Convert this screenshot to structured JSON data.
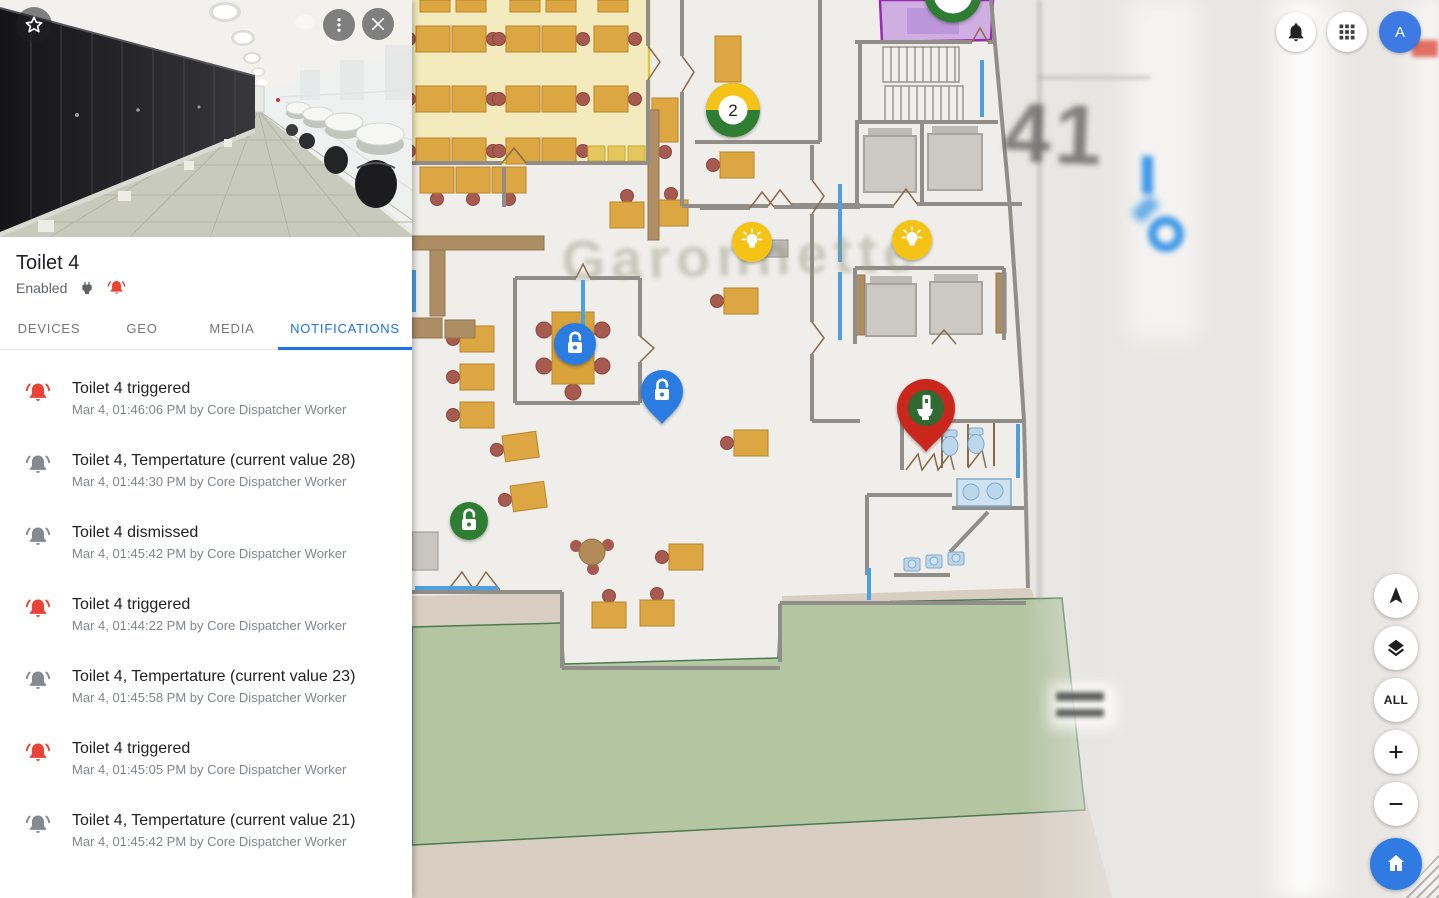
{
  "left_panel": {
    "title": "Toilet 4",
    "status": "Enabled",
    "tabs": [
      {
        "label": "DEVICES",
        "active": false
      },
      {
        "label": "GEO",
        "active": false
      },
      {
        "label": "MEDIA",
        "active": false
      },
      {
        "label": "NOTIFICATIONS",
        "active": true
      }
    ],
    "notifications": [
      {
        "type": "alert",
        "title": "Toilet 4 triggered",
        "meta": "Mar 4, 01:46:06 PM by Core Dispatcher Worker"
      },
      {
        "type": "info",
        "title": "Toilet 4, Tempertature (current value 28)",
        "meta": "Mar 4, 01:44:30 PM by Core Dispatcher Worker"
      },
      {
        "type": "info",
        "title": "Toilet 4 dismissed",
        "meta": "Mar 4, 01:45:42 PM by Core Dispatcher Worker"
      },
      {
        "type": "alert",
        "title": "Toilet 4 triggered",
        "meta": "Mar 4, 01:44:22 PM by Core Dispatcher Worker"
      },
      {
        "type": "info",
        "title": "Toilet 4, Tempertature (current value 23)",
        "meta": "Mar 4, 01:45:58 PM by Core Dispatcher Worker"
      },
      {
        "type": "alert",
        "title": "Toilet 4 triggered",
        "meta": "Mar 4, 01:45:05 PM by Core Dispatcher Worker"
      },
      {
        "type": "info",
        "title": "Toilet 4, Tempertature (current value 21)",
        "meta": "Mar 4, 01:45:42 PM by Core Dispatcher Worker"
      },
      {
        "type": "alert",
        "title": "Toilet 4, Tempertature (34 > 30)"
      }
    ]
  },
  "topbar": {
    "avatar_initial": "A"
  },
  "map": {
    "watermark": "Garonnette",
    "blurred_room_label": "41",
    "cluster_marker_count": "2",
    "controls": {
      "all": "ALL",
      "zoom_in": "+",
      "zoom_out": "−"
    },
    "markers": [
      {
        "type": "cluster",
        "label": "2",
        "colors": [
          "#f5c312",
          "#2e7d32"
        ]
      },
      {
        "type": "light-bulb",
        "color": "#f5c312"
      },
      {
        "type": "light-bulb",
        "color": "#f5c312"
      },
      {
        "type": "lock-open-circle",
        "color": "#2b7ce0"
      },
      {
        "type": "lock-open-pin",
        "color": "#2b7ce0"
      },
      {
        "type": "lock-open-circle",
        "color": "#2e7d32"
      },
      {
        "type": "toilet-pin",
        "color": "#c9251c"
      },
      {
        "type": "cluster-partial",
        "color": "#2e7d32"
      }
    ]
  },
  "icons": [
    "star-icon",
    "kebab-menu-icon",
    "close-icon",
    "power-plug-icon",
    "alarm-bell-icon",
    "notifications-bell-icon",
    "apps-grid-icon",
    "compass-arrow-icon",
    "layers-icon",
    "plus-icon",
    "minus-icon",
    "home-icon",
    "light-bulb-icon",
    "lock-open-icon",
    "toilet-icon"
  ],
  "colors": {
    "accent_blue": "#1a73e8",
    "alert_red": "#ea4335",
    "marker_green": "#2e7d32",
    "marker_yellow": "#f5c312",
    "pin_red": "#c9251c",
    "purple_room": "#9c27b0",
    "green_zone": "#b0c49e"
  }
}
